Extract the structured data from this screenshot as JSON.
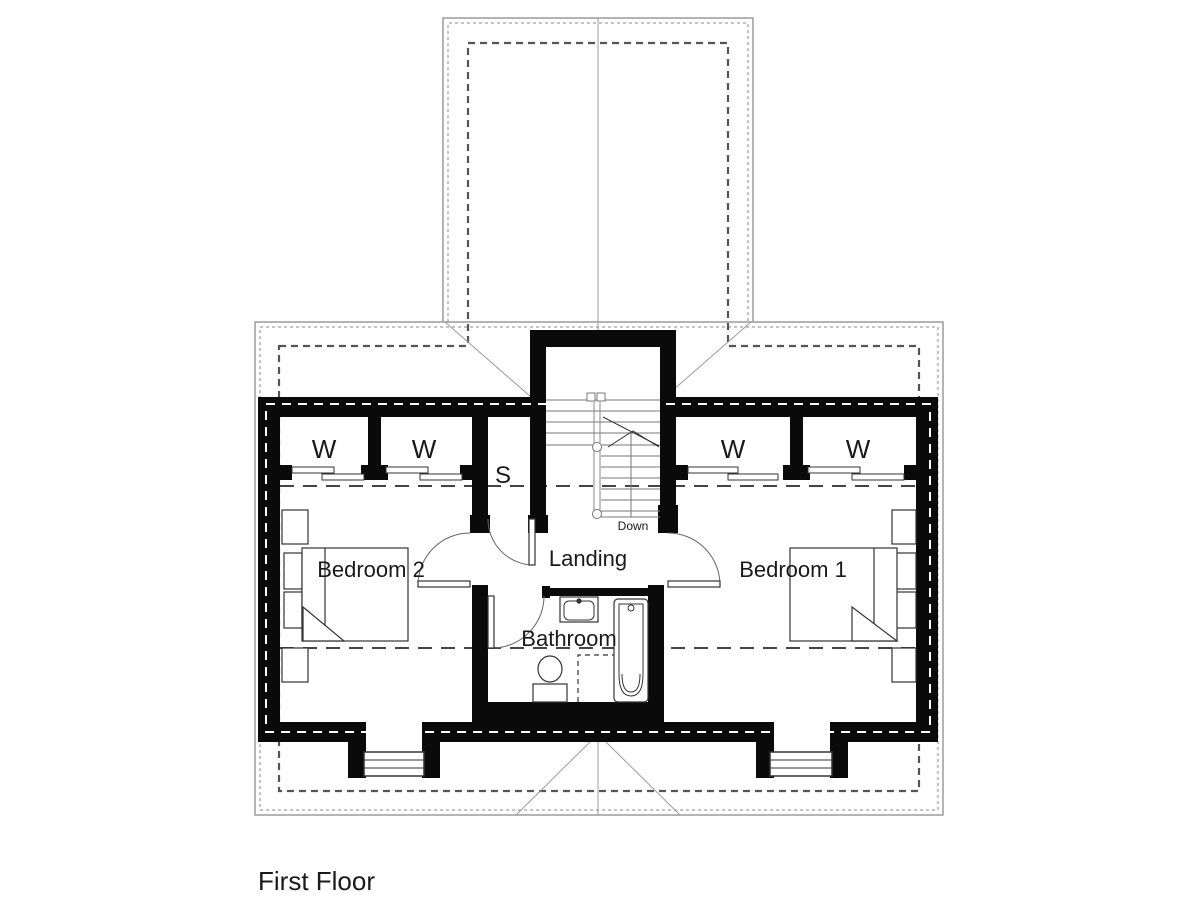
{
  "plan": {
    "title": "First Floor",
    "rooms": {
      "bedroom1": "Bedroom 1",
      "bedroom2": "Bedroom 2",
      "bathroom": "Bathroom",
      "landing": "Landing"
    },
    "closets": {
      "wardrobe1": "W",
      "wardrobe2": "W",
      "wardrobe3": "W",
      "wardrobe4": "W",
      "storage": "S"
    },
    "stairs": {
      "direction": "Down"
    },
    "colors": {
      "walls": "#0a0a0a",
      "roof_lines": "#9c9c9c",
      "dashed_overhang": "#555555",
      "text": "#1a1a1a",
      "background": "#ffffff"
    }
  }
}
